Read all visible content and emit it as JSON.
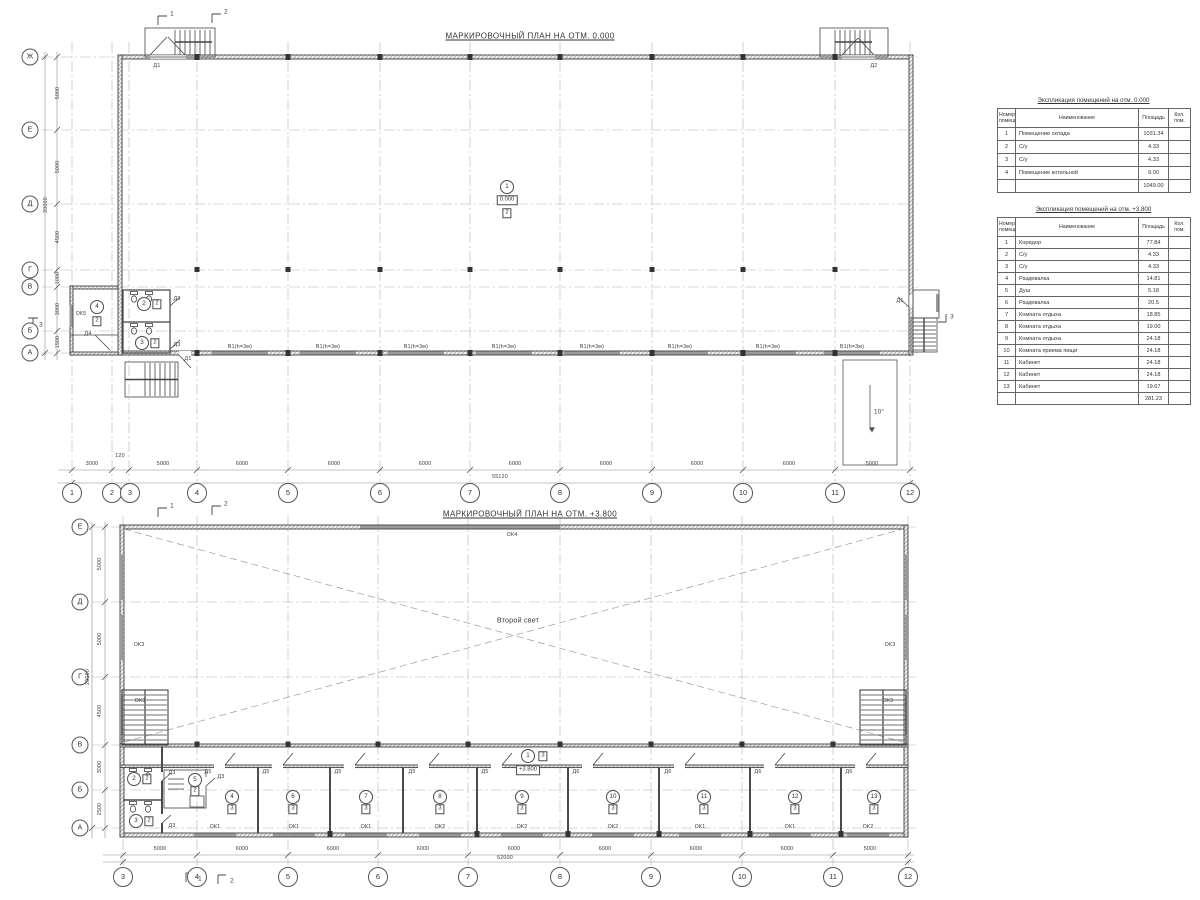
{
  "plans": {
    "ground_title": "МАРКИРОВОЧНЫЙ ПЛАН НА ОТМ. 0.000",
    "upper_title": "МАРКИРОВОЧНЫЙ ПЛАН НА ОТМ. +3.800"
  },
  "labels": {
    "d1": "Д1",
    "d2": "Д2",
    "d3": "Д3",
    "d4": "Д4",
    "d5": "Д5",
    "d6": "Д6",
    "ok1": "ОК1",
    "ok2": "ОК2",
    "ok3": "ОК3",
    "ok4": "ОК4",
    "ok5": "ОК5",
    "gate": "В1(h=3м)",
    "ramp_angle": "10°",
    "level_ground": "0.000",
    "level_upper": "+3.800",
    "second_light": "Второй свет"
  },
  "sections": {
    "s1": "1",
    "s2": "2",
    "s3": "3"
  },
  "grid": {
    "cols": [
      "1",
      "2",
      "3",
      "4",
      "5",
      "6",
      "7",
      "8",
      "9",
      "10",
      "11",
      "12"
    ],
    "rows_ground": [
      "Ж",
      "Е",
      "Д",
      "Г",
      "В",
      "Б",
      "А"
    ],
    "rows_upper": [
      "Е",
      "Д",
      "Г",
      "В",
      "Б",
      "А"
    ]
  },
  "dims": {
    "m3000": "3000",
    "m120": "120",
    "m5000": "5000",
    "m6000": "6000",
    "m4500": "4500",
    "m1000": "1000",
    "m1500": "1500",
    "m2500": "2500",
    "m20000": "20000",
    "ground_total": "55120",
    "upper_total": "52000"
  },
  "room_tags": {
    "r1": "1",
    "r2": "2",
    "r3": "3",
    "r4": "4",
    "r5": "5",
    "r6": "6",
    "r7": "7",
    "r8": "8",
    "r9": "9",
    "r10": "10",
    "r11": "11",
    "r12": "12",
    "r13": "13",
    "f2": "2",
    "f3": "3"
  },
  "tables": {
    "headers": {
      "num": "Номер помещ.",
      "name": "Наименование",
      "area": "Площадь",
      "count": "Кол. пом."
    },
    "ground": {
      "title": "Экспликация помещений на отм. 0.000",
      "rows": [
        [
          "1",
          "Помещение склада",
          "1031.34"
        ],
        [
          "2",
          "С/у",
          "4.33"
        ],
        [
          "3",
          "С/у",
          "4.33"
        ],
        [
          "4",
          "Помещение котельной",
          "9.00"
        ]
      ],
      "total": "1049.00"
    },
    "upper": {
      "title": "Экспликация помещений на отм. +3.800",
      "rows": [
        [
          "1",
          "Коридор",
          "77.84"
        ],
        [
          "2",
          "С/у",
          "4.33"
        ],
        [
          "3",
          "С/у",
          "4.33"
        ],
        [
          "4",
          "Раздевалка",
          "14.81"
        ],
        [
          "5",
          "Душ",
          "5.18"
        ],
        [
          "6",
          "Раздевалка",
          "20.5"
        ],
        [
          "7",
          "Комната отдыха",
          "18.85"
        ],
        [
          "8",
          "Комната отдыха",
          "19.00"
        ],
        [
          "9",
          "Комната отдыха",
          "24.18"
        ],
        [
          "10",
          "Комната приема пищи",
          "24.18"
        ],
        [
          "11",
          "Кабинет",
          "24.18"
        ],
        [
          "12",
          "Кабинет",
          "24.18"
        ],
        [
          "13",
          "Кабинет",
          "19.67"
        ]
      ],
      "total": "281.23"
    }
  }
}
